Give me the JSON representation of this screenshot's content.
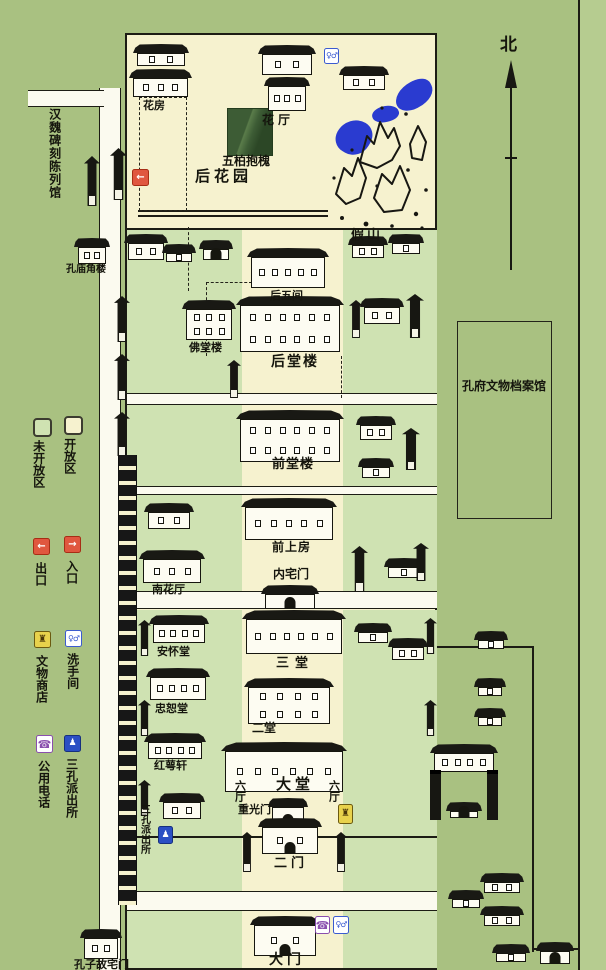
{
  "colors": {
    "background": "#a9c181",
    "open_area": "#f6f2cf",
    "closed_area": "#cfe2b2",
    "pond_blue": "#2a3bd0",
    "accent_red": "#e0573f",
    "shop_yellow": "#e8d24c",
    "icon_blue": "#2b4fc4",
    "phone_purple": "#8a4fae",
    "ink": "#1c1c14"
  },
  "compass": {
    "north": "北"
  },
  "legend": {
    "items": [
      {
        "label": "未开放区",
        "icon": "closed-area-swatch"
      },
      {
        "label": "开放区",
        "icon": "open-area-swatch"
      },
      {
        "label": "出口",
        "icon": "exit-icon"
      },
      {
        "label": "入口",
        "icon": "entrance-icon"
      },
      {
        "label": "文物商店",
        "icon": "shop-icon"
      },
      {
        "label": "洗手间",
        "icon": "restroom-icon"
      },
      {
        "label": "公用电话",
        "icon": "phone-icon"
      },
      {
        "label": "三孔派出所",
        "icon": "police-icon"
      }
    ]
  },
  "outside": {
    "hanwei": "汉魏碑刻陈列馆",
    "jiaolou": "孔庙角楼",
    "guzhai": "孔子故宅门"
  },
  "garden": {
    "huafang": "花房",
    "huating": "花厅",
    "wubai": "五柏抱槐",
    "houhuayuan": "后花园",
    "jiashan": "假山"
  },
  "axis": {
    "houwujian": "后五间",
    "houtanglou": "后堂楼",
    "qiantanglou": "前堂楼",
    "qianshangfang": "前上房",
    "neizhaimen": "内宅门",
    "santang": "三堂",
    "ertang": "二堂",
    "datang": "大堂",
    "liuting_left": "六厅",
    "liuting_right": "六厅",
    "chongguangmen": "重光门",
    "ermen": "二门",
    "damen": "大门"
  },
  "west": {
    "fotanglou": "佛堂楼",
    "nanhuating": "南花厅",
    "anhuaitang": "安怀堂",
    "zhongshutang": "忠恕堂",
    "hongexuan": "红萼轩"
  },
  "east": {
    "archive": "孔府文物档案馆"
  },
  "police_station_map": "三孔派出所",
  "icon_glyphs": {
    "exit": "←",
    "entrance": "→",
    "toilet": "♀♂",
    "phone": "☎",
    "police": "♟",
    "shop": "♜"
  }
}
